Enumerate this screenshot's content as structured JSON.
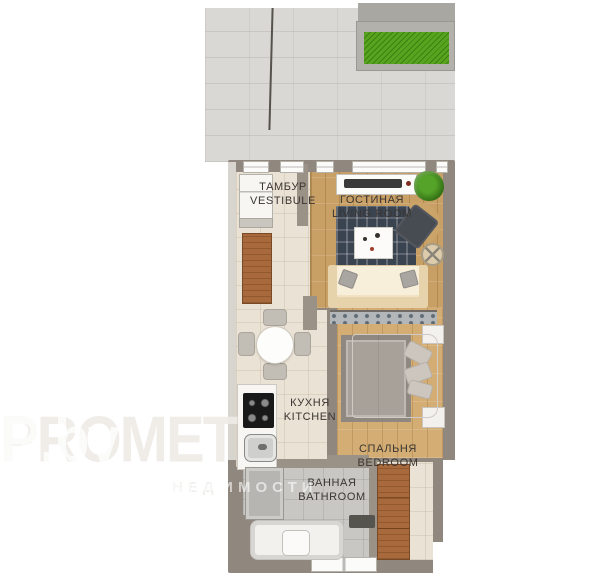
{
  "plan": {
    "kind": "apartment floor plan",
    "rooms": [
      {
        "id": "vestibule",
        "label_ru": "ТАМБУР",
        "label_en": "VESTIBULE"
      },
      {
        "id": "living-room",
        "label_ru": "ГОСТИНАЯ",
        "label_en": "LIVING ROOM"
      },
      {
        "id": "kitchen",
        "label_ru": "КУХНЯ",
        "label_en": "KITCHEN"
      },
      {
        "id": "bedroom",
        "label_ru": "СПАЛЬНЯ",
        "label_en": "BEDROOM"
      },
      {
        "id": "bathroom",
        "label_ru": "ВАННАЯ",
        "label_en": "BATHROOM"
      }
    ]
  },
  "watermark": {
    "brand_full": "PROMETR.by",
    "brand_faint": "PROMET",
    "brand_bright": "R.by",
    "tagline_faint": "НЕД",
    "tagline_bright": "ВИЖИМОСТИ"
  },
  "furniture": {
    "terrace": [
      "paving",
      "lawn-planter",
      "fence-line"
    ],
    "vestibule": [
      "built-in-closet",
      "shelf",
      "wardrobe"
    ],
    "living_room": [
      "tv-console",
      "tv",
      "potted-plant",
      "area-rug",
      "coffee-table",
      "armchair",
      "side-table",
      "sofa",
      "pillows",
      "console-shelf"
    ],
    "kitchen": [
      "dining-table",
      "four-chairs",
      "counter",
      "cooktop",
      "sink"
    ],
    "bedroom": [
      "double-bed",
      "pillows",
      "area-rug",
      "nightstand-top",
      "nightstand-bottom"
    ],
    "bathroom": [
      "shower",
      "bathtub",
      "toilet",
      "bath-mat"
    ],
    "hall": [
      "wardrobe"
    ]
  },
  "colors": {
    "wall": "#90877e",
    "wall_light": "#d8d5cf",
    "floor_tile": "#eae2d4",
    "floor_wood_living": "#c8a066",
    "floor_wood_bedroom": "#d4ad74",
    "floor_bathroom": "#c9c7c3",
    "terrace_paving": "#d9d8d4",
    "grass": "#58a41f",
    "rug_living": "#3a4350",
    "rug_bedroom": "#a7a19a",
    "wood_furniture": "#a86a3c",
    "sofa": "#f0e2c2",
    "watermark": "#ffffff"
  }
}
